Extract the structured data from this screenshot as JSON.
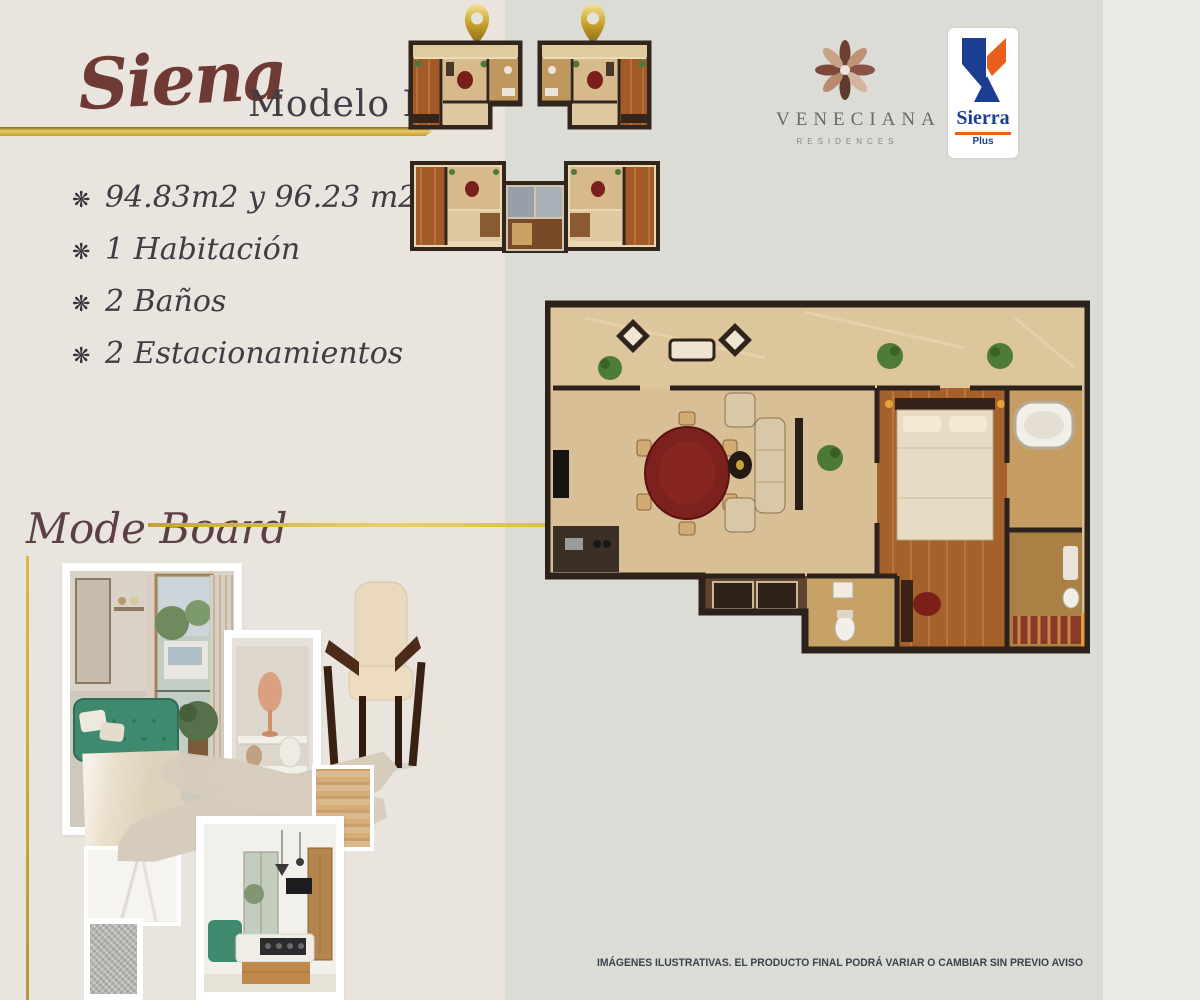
{
  "header": {
    "title": "Siena",
    "subtitle": "Modelo PH"
  },
  "features": {
    "bullet_icon": "❋",
    "items": [
      {
        "label": "94.83m2 y 96.23 m2"
      },
      {
        "label": "1 Habitación"
      },
      {
        "label": "2 Baños"
      },
      {
        "label": "2 Estacionamientos"
      }
    ]
  },
  "branding": {
    "veneciana": {
      "name": "VENECIANA",
      "tagline": "RESIDENCES",
      "icon": "veneciana-flower-icon"
    },
    "sierra": {
      "name": "Sierra",
      "sub": "Plus",
      "icon": "sierra-mountain-icon"
    }
  },
  "mode_board": {
    "title": "Mode Board"
  },
  "footer": {
    "disclaimer": "IMÁGENES ILUSTRATIVAS. EL PRODUCTO FINAL PODRÁ VARIAR O CAMBIAR SIN PREVIO AVISO"
  },
  "icons": {
    "location_pin": "location-pin-icon"
  },
  "colors": {
    "gold": "#c9a436",
    "title_maroon": "#6e3a33",
    "text_dark": "#3e3d44",
    "modeboard_title": "#5c4045",
    "sierra_blue": "#1c3e92",
    "sierra_orange": "#e8601c",
    "bg_left": "#e9e5de",
    "bg_mid": "#dcdcd6",
    "bg_right": "#eceae4"
  }
}
